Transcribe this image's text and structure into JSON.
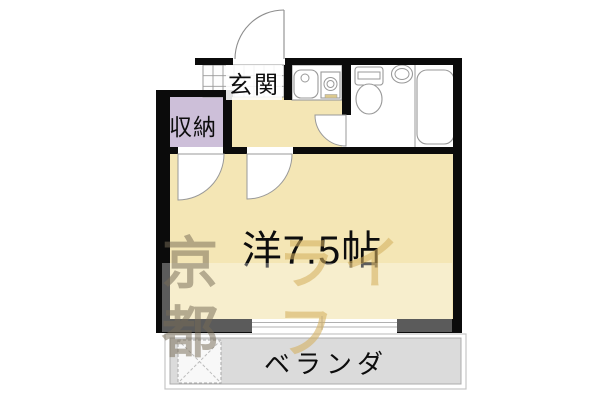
{
  "labels": {
    "genkan": "玄関",
    "storage": "収納",
    "main_room": "洋7.5帖",
    "veranda": "ベランダ"
  },
  "watermark": {
    "full_text": "京都ライフ",
    "part1": "京都",
    "part2": "ライフ"
  },
  "fixtures": [
    "entrance-door",
    "room-door",
    "storage-door",
    "bathroom-door",
    "kitchen-sink",
    "gas-stove",
    "toilet",
    "wash-basin",
    "bathtub",
    "sliding-window",
    "washing-machine-space"
  ],
  "colors": {
    "wall": "#0b0b0b",
    "room_fill": "#f4e6b5",
    "storage_fill": "#cdbfd9",
    "veranda_fill": "#dbdbdb",
    "outline": "#999999",
    "watermark_bg": "rgba(255,255,255,0.33)",
    "watermark_part1": "rgba(118,108,86,0.52)",
    "watermark_part2": "rgba(212,176,94,0.58)"
  }
}
